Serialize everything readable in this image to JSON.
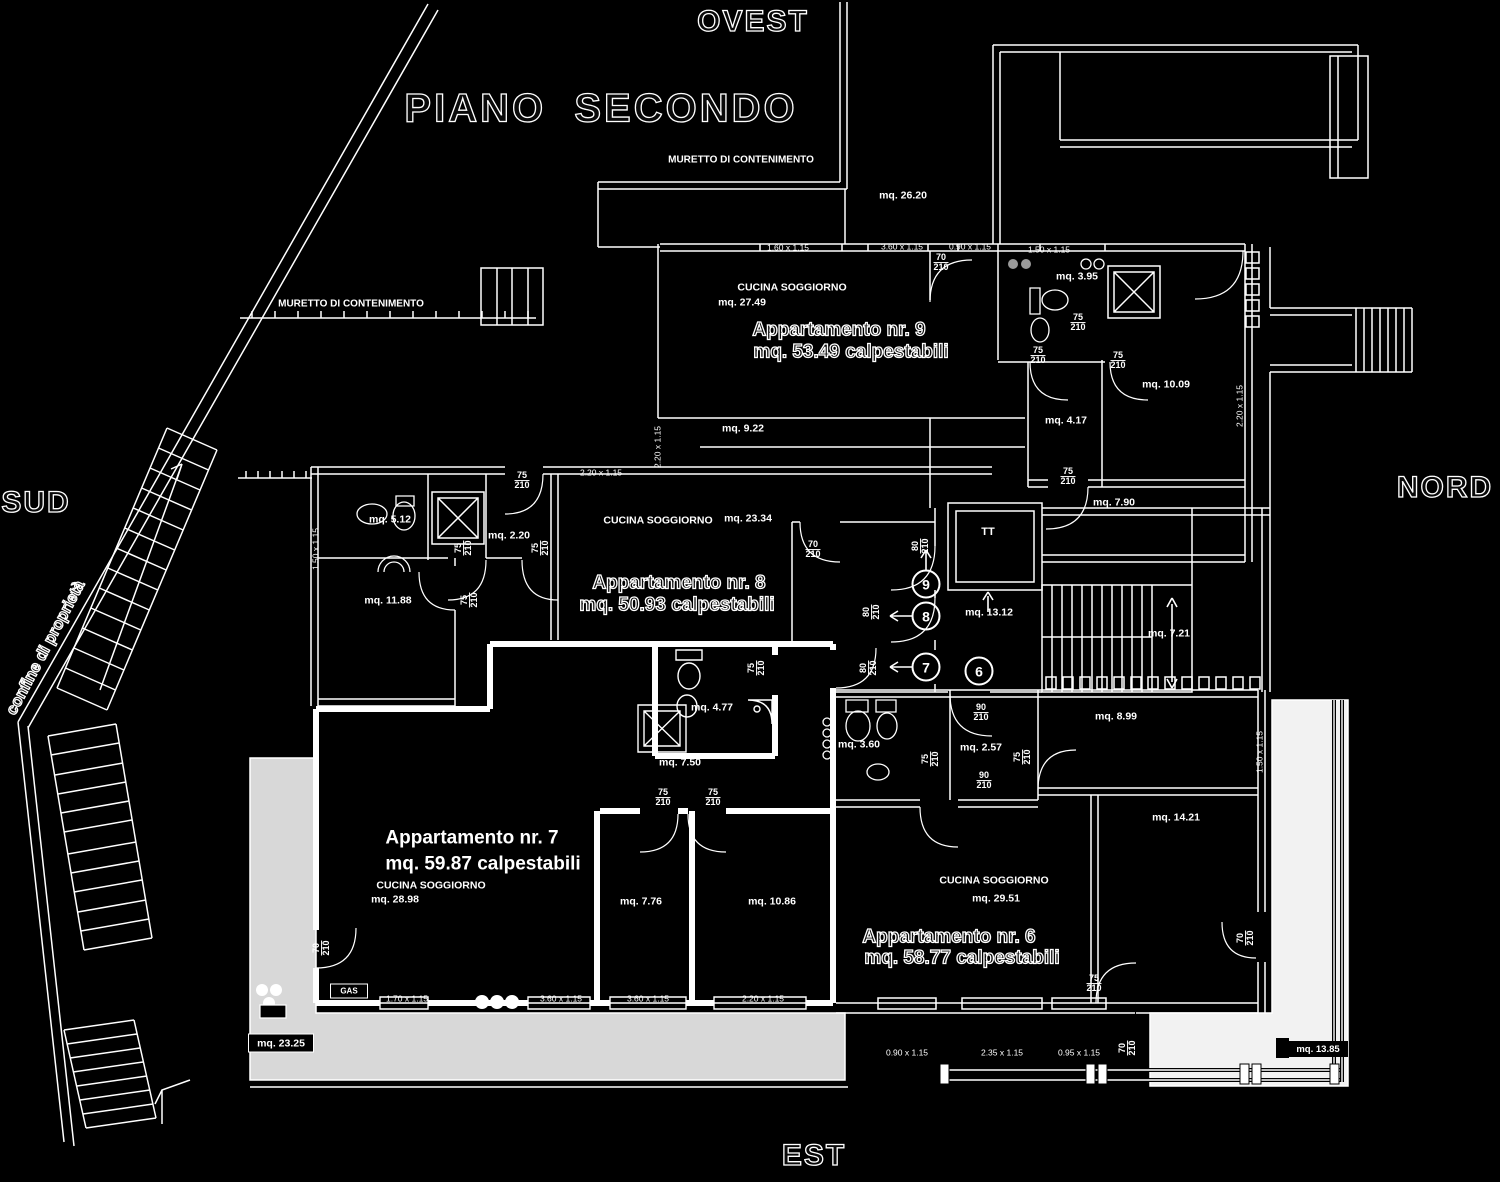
{
  "title": "PIANO  SECONDO",
  "compass": {
    "west": "OVEST",
    "south": "SUD",
    "north": "NORD",
    "east": "EST"
  },
  "colors": {
    "background": "#000000",
    "line": "#ffffff",
    "terrace_gray": "#d8d8d8",
    "terrace_light": "#f2f2f2"
  },
  "apartments": [
    {
      "number": "9",
      "area_label": "mq. 53.49 calpestabili"
    },
    {
      "number": "8",
      "area_label": "mq. 50.93 calpestabili"
    },
    {
      "number": "7",
      "area_label": "mq. 59.87 calpestabili"
    },
    {
      "number": "6",
      "area_label": "mq. 58.77 calpestabili"
    }
  ],
  "labels": [
    {
      "text": "OVEST",
      "x": 753,
      "y": 22,
      "fs": 30,
      "ls": 2,
      "cls": "o"
    },
    {
      "text": "PIANO  SECONDO",
      "x": 601,
      "y": 109,
      "fs": 40,
      "ls": 3,
      "cls": "o"
    },
    {
      "text": "SUD",
      "x": 36,
      "y": 503,
      "fs": 30,
      "ls": 2,
      "cls": "o"
    },
    {
      "text": "NORD",
      "x": 1445,
      "y": 488,
      "fs": 30,
      "ls": 2,
      "cls": "o"
    },
    {
      "text": "EST",
      "x": 814,
      "y": 1156,
      "fs": 30,
      "ls": 2,
      "cls": "o"
    },
    {
      "text": "confine di proprietà",
      "x": 46,
      "y": 648,
      "fs": 16,
      "rot": -62,
      "cls": "o"
    },
    {
      "text": "MURETTO DI CONTENIMENTO",
      "x": 741,
      "y": 161,
      "fs": 10
    },
    {
      "text": "MURETTO DI CONTENIMENTO",
      "x": 351,
      "y": 305,
      "fs": 10
    },
    {
      "text": "Appartamento nr. 9",
      "x": 839,
      "y": 331,
      "fs": 19,
      "cls": "o"
    },
    {
      "text": "mq. 53.49 calpestabili",
      "x": 851,
      "y": 353,
      "fs": 19,
      "cls": "o"
    },
    {
      "text": "Appartamento nr. 8",
      "x": 679,
      "y": 584,
      "fs": 19,
      "cls": "o"
    },
    {
      "text": "mq. 50.93 calpestabili",
      "x": 677,
      "y": 606,
      "fs": 19,
      "cls": "o"
    },
    {
      "text": "Appartamento nr. 7",
      "x": 472,
      "y": 839,
      "fs": 19
    },
    {
      "text": "mq. 59.87 calpestabili",
      "x": 483,
      "y": 865,
      "fs": 19
    },
    {
      "text": "Appartamento nr. 6",
      "x": 949,
      "y": 938,
      "fs": 19,
      "cls": "o"
    },
    {
      "text": "mq. 58.77 calpestabili",
      "x": 962,
      "y": 959,
      "fs": 19,
      "cls": "o"
    },
    {
      "text": "CUCINA SOGGIORNO",
      "x": 792,
      "y": 288,
      "fs": 10.5
    },
    {
      "text": "mq. 27.49",
      "x": 742,
      "y": 303,
      "fs": 10.5
    },
    {
      "text": "CUCINA SOGGIORNO",
      "x": 658,
      "y": 521,
      "fs": 10.5
    },
    {
      "text": "mq. 23.34",
      "x": 748,
      "y": 519,
      "fs": 10.5
    },
    {
      "text": "CUCINA SOGGIORNO",
      "x": 431,
      "y": 886,
      "fs": 10.5
    },
    {
      "text": "mq. 28.98",
      "x": 395,
      "y": 900,
      "fs": 10.5
    },
    {
      "text": "CUCINA SOGGIORNO",
      "x": 994,
      "y": 881,
      "fs": 10.5
    },
    {
      "text": "mq. 29.51",
      "x": 996,
      "y": 899,
      "fs": 10.5
    },
    {
      "text": "mq. 26.20",
      "x": 903,
      "y": 196,
      "fs": 10.5
    },
    {
      "text": "mq. 9.22",
      "x": 743,
      "y": 429,
      "fs": 10.5
    },
    {
      "text": "mq. 5.12",
      "x": 390,
      "y": 520,
      "fs": 10.5
    },
    {
      "text": "mq. 2.20",
      "x": 509,
      "y": 536,
      "fs": 10.5
    },
    {
      "text": "mq. 11.88",
      "x": 388,
      "y": 601,
      "fs": 10.5
    },
    {
      "text": "mq. 3.95",
      "x": 1077,
      "y": 277,
      "fs": 10.5
    },
    {
      "text": "mq. 10.09",
      "x": 1166,
      "y": 385,
      "fs": 10.5
    },
    {
      "text": "mq. 4.17",
      "x": 1066,
      "y": 421,
      "fs": 10.5
    },
    {
      "text": "mq. 7.90",
      "x": 1114,
      "y": 503,
      "fs": 10.5
    },
    {
      "text": "mq. 13.12",
      "x": 989,
      "y": 613,
      "fs": 10.5
    },
    {
      "text": "mq. 7.21",
      "x": 1169,
      "y": 634,
      "fs": 10.5
    },
    {
      "text": "mq. 4.77",
      "x": 712,
      "y": 708,
      "fs": 10.5
    },
    {
      "text": "mq. 7.50",
      "x": 680,
      "y": 763,
      "fs": 10.5
    },
    {
      "text": "mq. 3.60",
      "x": 859,
      "y": 745,
      "fs": 10.5
    },
    {
      "text": "mq. 2.57",
      "x": 981,
      "y": 748,
      "fs": 10.5
    },
    {
      "text": "mq. 7.76",
      "x": 641,
      "y": 902,
      "fs": 10.5
    },
    {
      "text": "mq. 10.86",
      "x": 772,
      "y": 902,
      "fs": 10.5
    },
    {
      "text": "mq. 8.99",
      "x": 1116,
      "y": 717,
      "fs": 10.5
    },
    {
      "text": "mq. 14.21",
      "x": 1176,
      "y": 818,
      "fs": 10.5
    },
    {
      "text": "TT",
      "x": 988,
      "y": 533,
      "fs": 11
    }
  ],
  "window_dims": [
    {
      "text": "1.60 x 1.15",
      "x": 788,
      "y": 248
    },
    {
      "text": "3.60 x 1.15",
      "x": 902,
      "y": 247
    },
    {
      "text": "0.90 x 1.15",
      "x": 970,
      "y": 247
    },
    {
      "text": "1.50 x 1.15",
      "x": 1049,
      "y": 250
    },
    {
      "text": "2.20 x 1.15",
      "x": 601,
      "y": 473
    },
    {
      "text": "2.20 x 1.15",
      "x": 658,
      "y": 447,
      "rot": -90
    },
    {
      "text": "1.50 x 1.15",
      "x": 316,
      "y": 549,
      "rot": -90
    },
    {
      "text": "2.20 x 1.15",
      "x": 1240,
      "y": 406,
      "rot": -90
    },
    {
      "text": "1.50 x 1.15",
      "x": 1260,
      "y": 752,
      "rot": -90
    },
    {
      "text": "1.70 x 1.15",
      "x": 407,
      "y": 999
    },
    {
      "text": "3.60 x 1.15",
      "x": 561,
      "y": 999
    },
    {
      "text": "3.60 x 1.15",
      "x": 648,
      "y": 999
    },
    {
      "text": "2.20 x 1.15",
      "x": 763,
      "y": 999
    },
    {
      "text": "0.90 x 1.15",
      "x": 907,
      "y": 1053
    },
    {
      "text": "2.35 x 1.15",
      "x": 1002,
      "y": 1053
    },
    {
      "text": "0.95 x 1.15",
      "x": 1079,
      "y": 1053
    }
  ],
  "door_labels": [
    {
      "top": "70",
      "bottom": "210",
      "x": 941,
      "y": 263
    },
    {
      "top": "75",
      "bottom": "210",
      "x": 1078,
      "y": 323
    },
    {
      "top": "75",
      "bottom": "210",
      "x": 1038,
      "y": 356
    },
    {
      "top": "75",
      "bottom": "210",
      "x": 1118,
      "y": 361
    },
    {
      "top": "75",
      "bottom": "210",
      "x": 1068,
      "y": 477
    },
    {
      "top": "75",
      "bottom": "210",
      "x": 522,
      "y": 481
    },
    {
      "top": "70",
      "bottom": "210",
      "x": 813,
      "y": 550
    },
    {
      "top": "80",
      "bottom": "210",
      "x": 921,
      "y": 546,
      "rot": -90
    },
    {
      "top": "75",
      "bottom": "210",
      "x": 464,
      "y": 548,
      "rot": -90
    },
    {
      "top": "75",
      "bottom": "210",
      "x": 541,
      "y": 548,
      "rot": -90
    },
    {
      "top": "75",
      "bottom": "210",
      "x": 470,
      "y": 600,
      "rot": -90
    },
    {
      "top": "80",
      "bottom": "210",
      "x": 872,
      "y": 612,
      "rot": -90
    },
    {
      "top": "80",
      "bottom": "210",
      "x": 869,
      "y": 668,
      "rot": -90
    },
    {
      "top": "75",
      "bottom": "210",
      "x": 757,
      "y": 668,
      "rot": -90
    },
    {
      "top": "90",
      "bottom": "210",
      "x": 981,
      "y": 713
    },
    {
      "top": "75",
      "bottom": "210",
      "x": 931,
      "y": 759,
      "rot": -90
    },
    {
      "top": "75",
      "bottom": "210",
      "x": 1023,
      "y": 757,
      "rot": -90
    },
    {
      "top": "90",
      "bottom": "210",
      "x": 984,
      "y": 781
    },
    {
      "top": "75",
      "bottom": "210",
      "x": 663,
      "y": 798
    },
    {
      "top": "75",
      "bottom": "210",
      "x": 713,
      "y": 798
    },
    {
      "top": "70",
      "bottom": "210",
      "x": 322,
      "y": 948,
      "rot": -90
    },
    {
      "top": "75",
      "bottom": "210",
      "x": 1094,
      "y": 984
    },
    {
      "top": "70",
      "bottom": "210",
      "x": 1246,
      "y": 938,
      "rot": -90
    },
    {
      "top": "70",
      "bottom": "210",
      "x": 1128,
      "y": 1048,
      "rot": -90
    }
  ],
  "chips": [
    {
      "text": "GAS",
      "x": 349,
      "y": 991,
      "w": 36,
      "h": 13,
      "bg": "transparent",
      "border": true,
      "fs": 8
    },
    {
      "text": "mq. 23.25",
      "x": 281,
      "y": 1043,
      "w": 64,
      "h": 17,
      "bg": "#000000",
      "border": true,
      "fs": 10.5
    },
    {
      "text": "mq. 13.85",
      "x": 1318,
      "y": 1049,
      "w": 60,
      "h": 16,
      "bg": "#000000",
      "border": false,
      "fs": 9.5
    }
  ],
  "circled_units": [
    {
      "n": "9",
      "x": 926,
      "y": 584
    },
    {
      "n": "8",
      "x": 926,
      "y": 616
    },
    {
      "n": "7",
      "x": 926,
      "y": 667
    },
    {
      "n": "6",
      "x": 979,
      "y": 671
    }
  ]
}
